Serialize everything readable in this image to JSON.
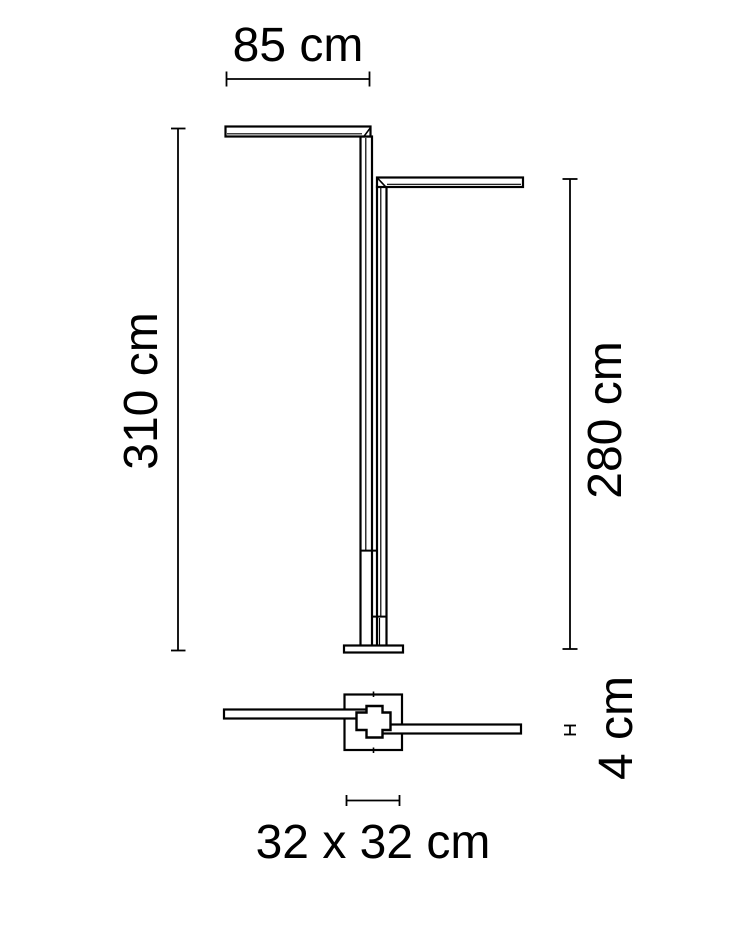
{
  "diagram": {
    "type": "product-dimension-drawing",
    "subject": "two-arm floor lamp, front elevation and plan (top) view",
    "background_color": "#ffffff",
    "line_color": "#000000",
    "units": "cm",
    "labels": {
      "arm_length": "85 cm",
      "height_primary": "310 cm",
      "height_secondary": "280 cm",
      "base_plate": "32 x 32 cm",
      "base_thickness": "4 cm"
    },
    "values": {
      "arm_length_cm": 85,
      "height_primary_cm": 310,
      "height_secondary_cm": 280,
      "base_plate_cm": "32 x 32",
      "base_thickness_cm": 4
    }
  }
}
